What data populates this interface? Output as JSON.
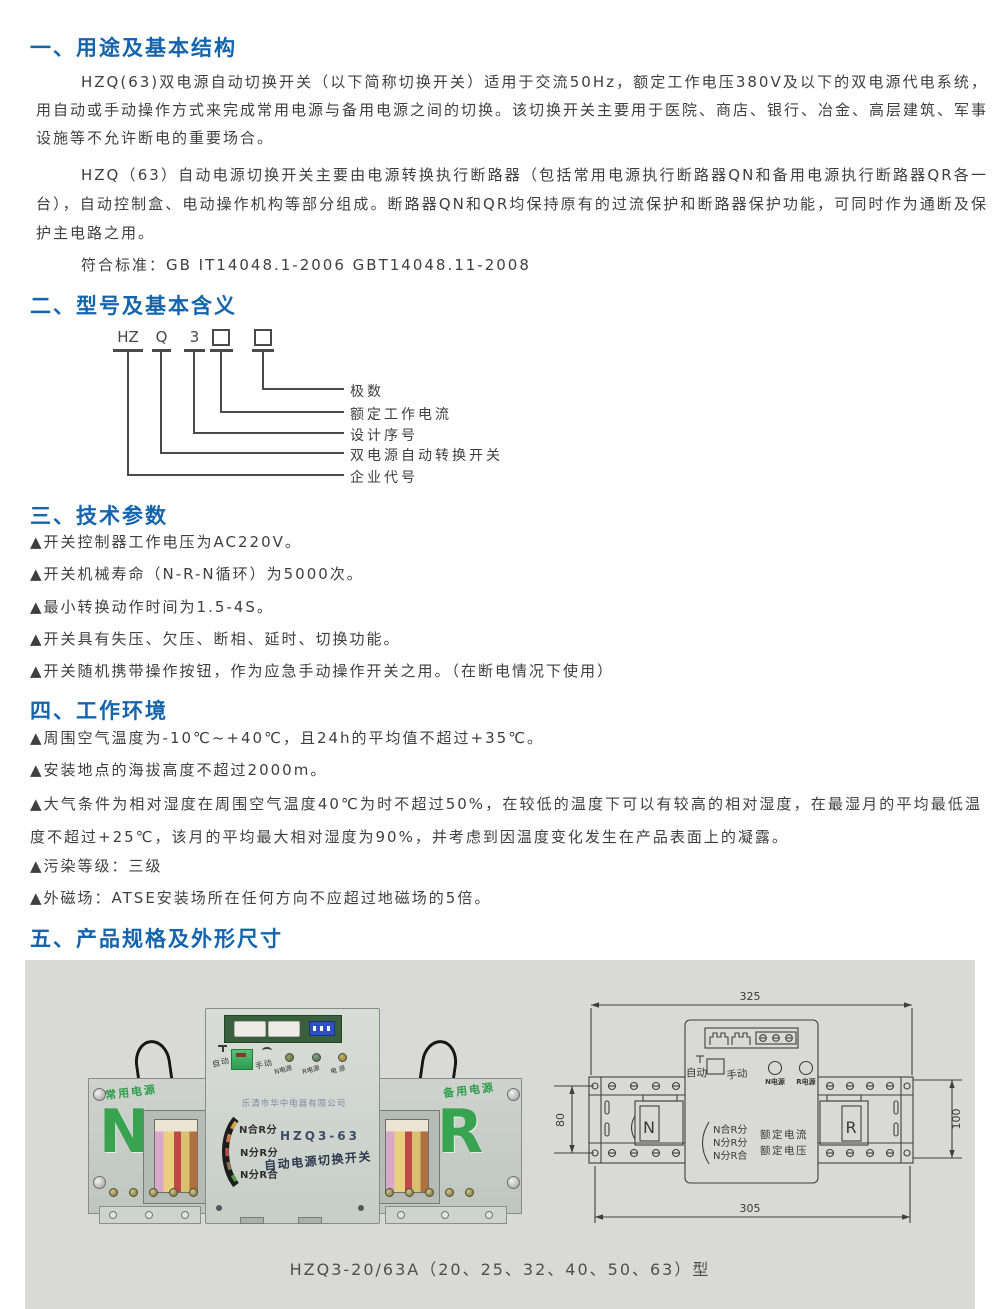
{
  "colors": {
    "heading_blue": "#1464ae",
    "body_text": "#3f3f3f",
    "panel_gray": "#d9d9d8",
    "brand_green": "#38a350",
    "pcb_green": "#3a5f3c",
    "dip_blue": "#2d51c4",
    "drawing_line": "#3f3f3f"
  },
  "sections": {
    "s1": {
      "title": "一、用途及基本结构",
      "p1": "HZQ(63)双电源自动切换开关（以下简称切换开关）适用于交流50Hz，额定工作电压380V及以下的双电源代电系统，用自动或手动操作方式来完成常用电源与备用电源之间的切换。该切换开关主要用于医院、商店、银行、冶金、高层建筑、军事设施等不允许断电的重要场合。",
      "p2": "HZQ（63）自动电源切换开关主要由电源转换执行断路器（包括常用电源执行断路器QN和备用电源执行断路器QR各一台），自动控制盒、电动操作机构等部分组成。断路器QN和QR均保持原有的过流保护和断路器保护功能，可同时作为通断及保护主电路之用。",
      "p3": "符合标准：GB IT14048.1-2006  GBT14048.11-2008"
    },
    "s2": {
      "title": "二、型号及基本含义",
      "code": {
        "c1": "HZ",
        "c2": "Q",
        "c3": "3"
      },
      "labels": [
        "极数",
        "额定工作电流",
        "设计序号",
        "双电源自动转换开关",
        "企业代号"
      ]
    },
    "s3": {
      "title": "三、技术参数",
      "items": [
        "▲开关控制器工作电压为AC220V。",
        "▲开关机械寿命（N-R-N循环）为5000次。",
        "▲最小转换动作时间为1.5-4S。",
        "▲开关具有失压、欠压、断相、延时、切换功能。",
        "▲开关随机携带操作按钮，作为应急手动操作开关之用。（在断电情况下使用）"
      ]
    },
    "s4": {
      "title": "四、工作环境",
      "items": [
        "▲周围空气温度为-10℃~+40℃，且24h的平均值不超过+35℃。",
        "▲安装地点的海拔高度不超过2000m。",
        "▲大气条件为相对湿度在周围空气温度40℃为时不超过50%，在较低的温度下可以有较高的相对湿度，在最湿月的平均最低温度不超过+25℃，该月的平均最大相对湿度为90%，并考虑到因温度变化发生在产品表面上的凝露。",
        "▲污染等级：三级",
        "▲外磁场：ATSE安装场所在任何方向不应超过地磁场的5倍。"
      ]
    },
    "s5": {
      "title": "五、产品规格及外形尺寸",
      "photo": {
        "auto": "自动",
        "manual": "手动",
        "led1": "N电源",
        "led2": "R电源",
        "led3": "电 源",
        "company": "乐清市华中电器有限公司",
        "pos1": "N合R分",
        "pos2": "N分R分",
        "pos3": "N分R合",
        "model": "HZQ3-63",
        "product_name": "自动电源切换开关",
        "left_label": "常用电源",
        "left_letter": "N",
        "right_label": "备用电源",
        "right_letter": "R"
      },
      "drawing": {
        "dim_top": "325",
        "dim_bottom": "305",
        "dim_left": "80",
        "dim_right": "100",
        "auto": "自动",
        "manual": "手动",
        "led_n": "N电源",
        "led_r": "R电源",
        "pos1": "N合R分",
        "pos2": "N分R分",
        "pos3": "N分R合",
        "rated_current": "额定电流",
        "rated_voltage": "额定电压",
        "breaker_n": "N",
        "breaker_r": "R"
      },
      "caption": "HZQ3-20/63A（20、25、32、40、50、63）型"
    }
  }
}
